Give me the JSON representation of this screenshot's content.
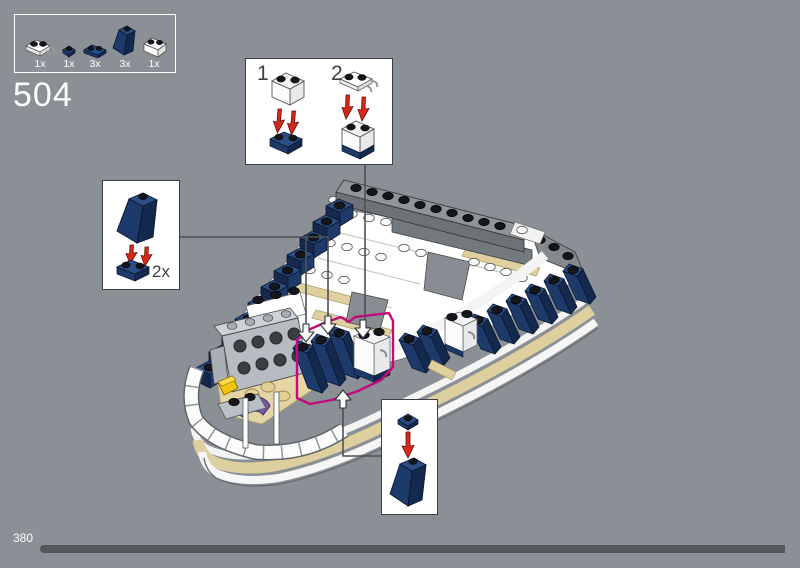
{
  "step": {
    "number": "504"
  },
  "parts_panel": {
    "parts": [
      {
        "name": "white-plate-1x2-with-clips",
        "count": "1x",
        "color": "#FFFFFF"
      },
      {
        "name": "dark-blue-plate-1x1",
        "count": "1x",
        "color": "#1E3A69"
      },
      {
        "name": "dark-blue-plate-1x2",
        "count": "3x",
        "color": "#1E3A69"
      },
      {
        "name": "dark-blue-slope-1x2",
        "count": "3x",
        "color": "#1E3A69"
      },
      {
        "name": "trans-clear-brick-1x2",
        "count": "1x",
        "color": "#FFFFFF"
      }
    ]
  },
  "callouts": {
    "steps_box": {
      "step1_label": "1",
      "step2_label": "2"
    },
    "repeat_box": {
      "label": "2x"
    },
    "single_box": {
      "label": ""
    }
  },
  "colors": {
    "background": "#8A9096",
    "dark_blue": "#1E3A69",
    "dark_blue_light": "#2C4D85",
    "dark_blue_dark": "#14294E",
    "tan": "#DECF9F",
    "magenta_highlight": "#C6097D",
    "red_arrow": "#D42A1C",
    "callout_line": "#4D5154",
    "progress_bar": "#54585C"
  },
  "footer": {
    "page_number": "380",
    "progress_percent": 98
  }
}
